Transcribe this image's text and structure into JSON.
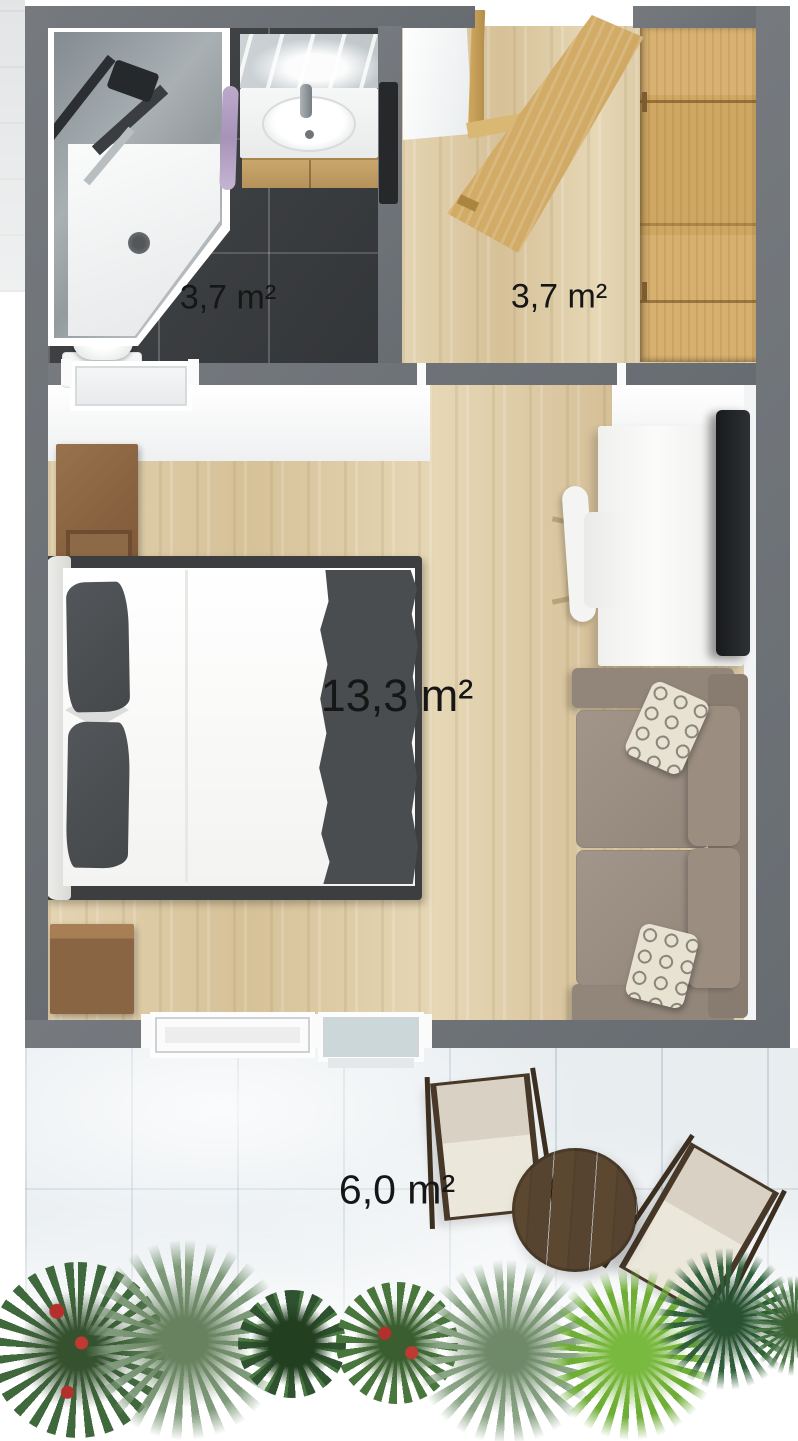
{
  "plan": {
    "view": "3D top-down floor plan of a studio apartment with terrace"
  },
  "rooms": {
    "bathroom": {
      "area_label": "3,7 m²"
    },
    "hallway": {
      "area_label": "3,7 m²"
    },
    "bedroom": {
      "area_label": "13,3 m²"
    },
    "terrace": {
      "area_label": "6,0 m²"
    }
  },
  "colors": {
    "wall_gray": "#6e7277",
    "wood_floor": "#dccaa5",
    "bathroom_tile": "#3a3d40",
    "oak_wardrobe_door": "#cfa763",
    "terrace_tile": "#e8edf0",
    "sofa_taupe": "#9b8e81",
    "bed_accent_gray": "#4a4d4f",
    "table_walnut": "#57432e",
    "towel_lilac": "#b3a0c4",
    "label_text": "#161616"
  },
  "furniture": [
    "corner-shower",
    "vanity-sink-with-mirror",
    "toilet",
    "towel",
    "wall-radiator",
    "wardrobe",
    "entry-door-open",
    "bathroom-door-open",
    "double-bed",
    "nightstand",
    "nightstand",
    "desk-dresser",
    "tv",
    "desk-chair",
    "sofa-with-pillows",
    "deck-chair",
    "deck-chair",
    "round-table",
    "plants"
  ]
}
